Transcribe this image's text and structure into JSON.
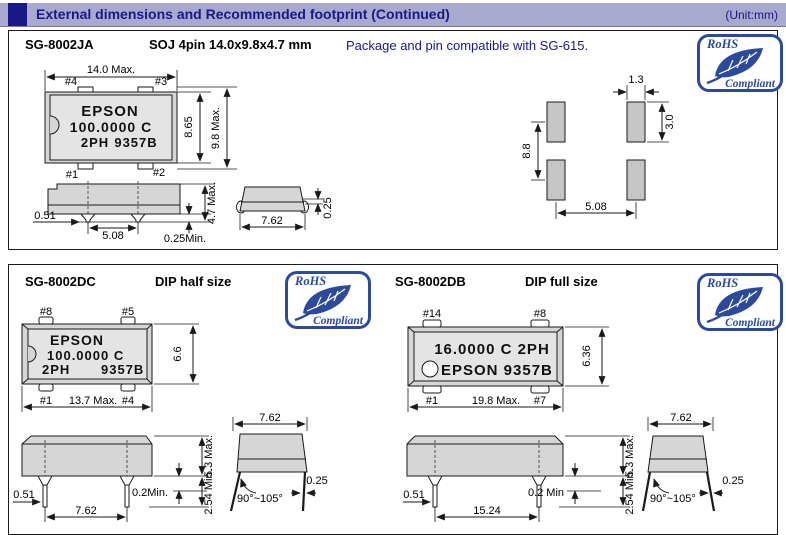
{
  "header": {
    "title": "External dimensions and Recommended footprint (Continued)",
    "unit": "(Unit:mm)"
  },
  "rohs": {
    "top": "RoHS",
    "bottom": "Compliant"
  },
  "ja": {
    "model": "SG-8002JA",
    "package": "SOJ 4pin 14.0x9.8x4.7 mm",
    "note": "Package and pin compatible with SG-615.",
    "marking": {
      "l1": "EPSON",
      "l2": "100.0000 C",
      "l3a": "2PH",
      "l3b": "9357B"
    },
    "pins": {
      "tl": "#4",
      "tr": "#3",
      "bl": "#1",
      "br": "#2"
    },
    "dims": {
      "width": "14.0 Max.",
      "inner_height": "8.65",
      "height": "9.8 Max.",
      "body_height": "4.7 Max.",
      "lead_width": "0.51",
      "lead_pitch": "5.08",
      "standoff": "0.25Min.",
      "side_width": "7.62",
      "lid": "0.25"
    },
    "footprint": {
      "pad_width": "1.3",
      "pad_height": "3.0",
      "row_pitch": "8.8",
      "pad_pitch": "5.08"
    }
  },
  "dc": {
    "model": "SG-8002DC",
    "package": "DIP half size",
    "marking": {
      "l1": "EPSON",
      "l2": "100.0000 C",
      "l3a": "2PH",
      "l3b": "9357B"
    },
    "pins": {
      "tl": "#8",
      "tr": "#5",
      "bl": "#1",
      "br": "#4"
    },
    "dims": {
      "width": "13.7 Max.",
      "height": "6.6",
      "lead_width": "0.51",
      "lead_pitch": "7.62",
      "standoff": "0.2Min.",
      "body_height": "5.3 Max.",
      "lead_length": "2.54 Min.",
      "side_width": "7.62",
      "lead_thickness": "0.25",
      "lead_angle": "90°~105°"
    }
  },
  "db": {
    "model": "SG-8002DB",
    "package": "DIP full size",
    "marking": {
      "l1": "16.0000 C 2PH",
      "l2": "EPSON 9357B"
    },
    "pins": {
      "tl": "#14",
      "tr": "#8",
      "bl": "#1",
      "br": "#7"
    },
    "dims": {
      "width": "19.8 Max.",
      "height": "6.36",
      "lead_width": "0.51",
      "lead_pitch": "15.24",
      "standoff": "0.2 Min",
      "body_height": "5.3 Max.",
      "lead_length": "2.54 Min.",
      "side_width": "7.62",
      "lead_thickness": "0.25",
      "lead_angle": "90°~105°"
    }
  },
  "colors": {
    "hdr-bg": "#a9a9cf",
    "navy": "#181888",
    "rohs": "#2b4a9c",
    "body-fill": "#d6d6d6",
    "label-fill": "#e4e4e4",
    "pad-fill": "#c6c6c6",
    "ink": "#1a1a1a"
  }
}
